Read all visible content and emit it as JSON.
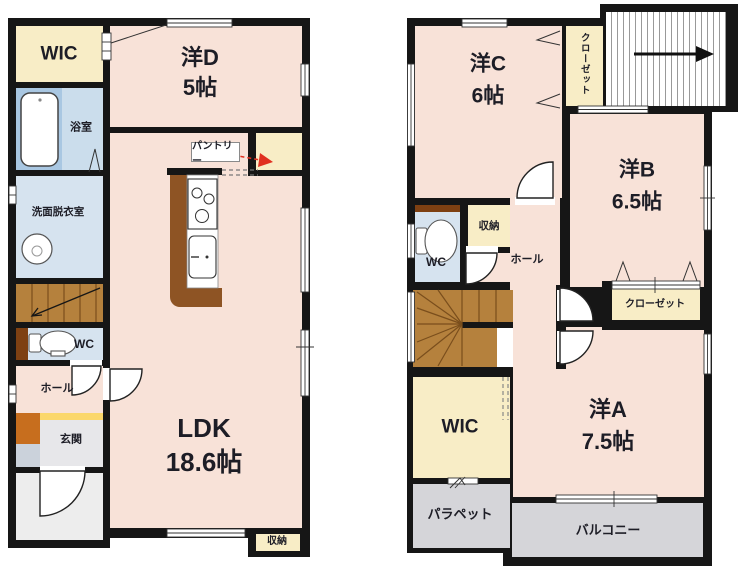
{
  "palette": {
    "wall": "#161616",
    "room_pink": "#F8E2D8",
    "closet_cream": "#F8EDC6",
    "bath_blue_dark": "#A9C7E2",
    "bath_blue_light": "#CBDDEC",
    "wash_blue": "#D6E3EF",
    "stair_brown": "#B5813D",
    "kitchen_brown": "#8E5424",
    "wc_brown": "#7E4012",
    "entrance_orange": "#C76E1E",
    "entrance_yellow": "#FBD76B",
    "entrance_gray": "#E7E7EA",
    "porch_gray": "#EDEDED",
    "balcony_gray": "#D5D5D9",
    "shoe_bluegray": "#CBD2DB",
    "arrow_red": "#E03020"
  },
  "floor1": {
    "wic": "WIC",
    "bathroom": "浴室",
    "washroom": "洗面脱衣室",
    "wc": "WC",
    "hall": "ホール",
    "entrance": "玄関",
    "pantry": "パントリー",
    "storage": "収納",
    "room_d": {
      "name": "洋D",
      "size": "5帖"
    },
    "ldk": {
      "name": "LDK",
      "size": "18.6帖"
    }
  },
  "floor2": {
    "room_c": {
      "name": "洋C",
      "size": "6帖"
    },
    "closet_top": "クローゼット",
    "room_b": {
      "name": "洋B",
      "size": "6.5帖"
    },
    "wc": "WC",
    "storage": "収納",
    "hall": "ホール",
    "closet_mid": "クローゼット",
    "wic": "WIC",
    "room_a": {
      "name": "洋A",
      "size": "7.5帖"
    },
    "parapet": "パラペット",
    "balcony": "バルコニー"
  }
}
